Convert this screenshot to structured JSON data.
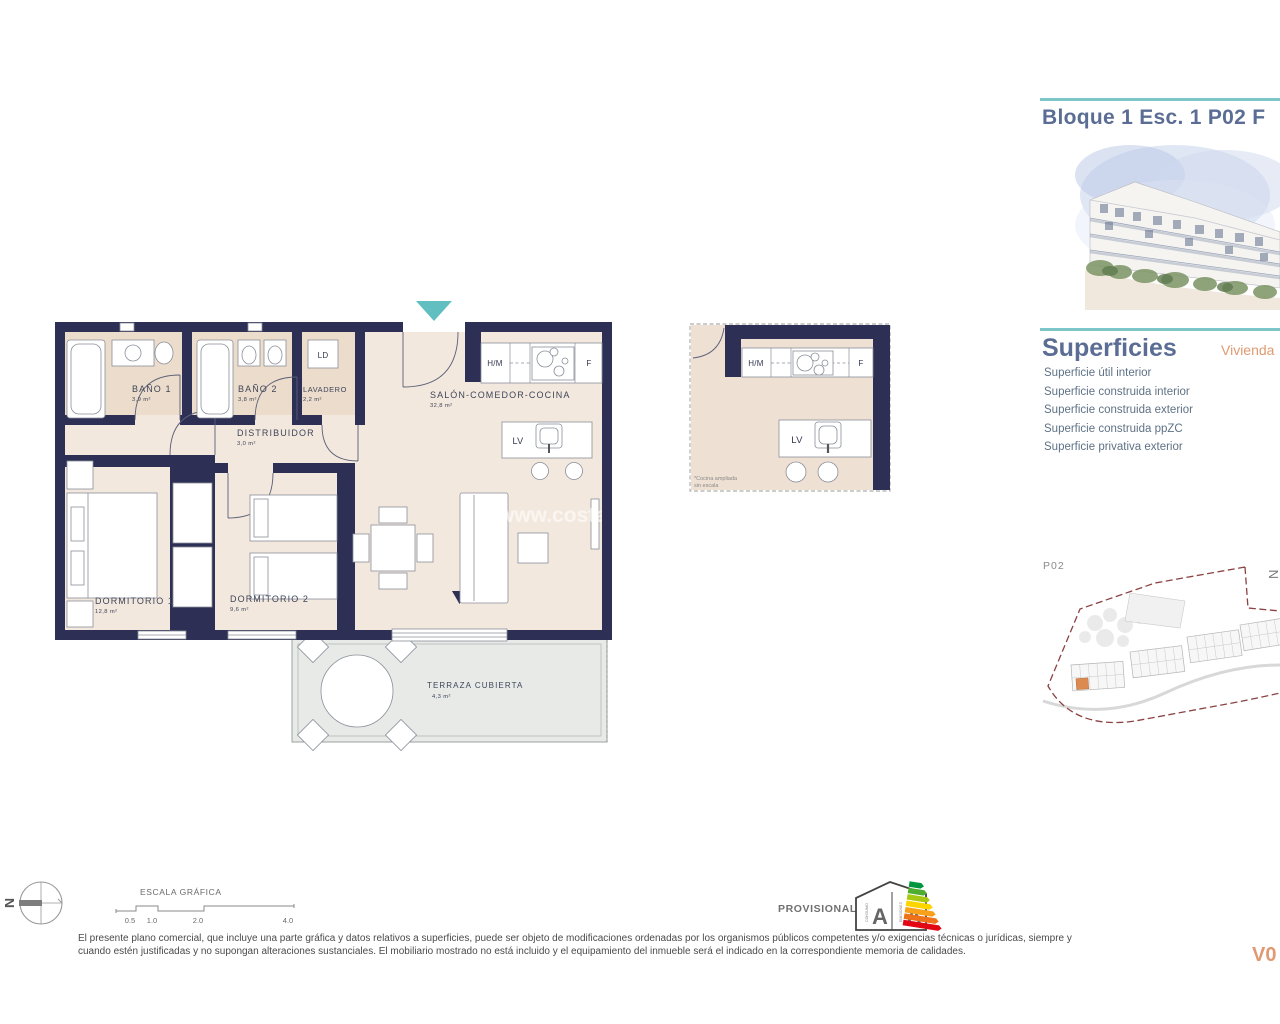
{
  "page": {
    "title": "Bloque 1 Esc. 1 P02 F",
    "version": "V0"
  },
  "superficies": {
    "heading": "Superficies",
    "column_label": "Vivienda",
    "items": [
      "Superficie útil interior",
      "Superficie construida interior",
      "Superficie construida exterior",
      "Superficie construida ppZC",
      "Superficie privativa exterior"
    ]
  },
  "plan": {
    "rooms": [
      {
        "name": "BAÑO 1",
        "area": "3,9 m²"
      },
      {
        "name": "BAÑO 2",
        "area": "3,8 m²"
      },
      {
        "name": "LAVADERO",
        "area": "2,2 m²"
      },
      {
        "name": "DISTRIBUIDOR",
        "area": "3,0 m²"
      },
      {
        "name": "SALÓN-COMEDOR-COCINA",
        "area": "32,8 m²"
      },
      {
        "name": "DORMITORIO 1",
        "area": "12,8 m²"
      },
      {
        "name": "DORMITORIO 2",
        "area": "9,6 m²"
      },
      {
        "name": "TERRAZA CUBIERTA",
        "area": "4,3 m²"
      }
    ],
    "fixtures": {
      "ld": "LD",
      "hm": "H/M",
      "f": "F",
      "lv": "LV"
    },
    "watermark": "www.costablan"
  },
  "detail": {
    "fixtures": {
      "hm": "H/M",
      "f": "F",
      "lv": "LV"
    },
    "note_line1": "*Cocina ampliada",
    "note_line2": "sin escala"
  },
  "siteplan": {
    "label": "P02",
    "north": "N"
  },
  "scalebar": {
    "title": "ESCALA GRÁFICA",
    "ticks": [
      "0.5",
      "1.0",
      "2.0",
      "4.0"
    ]
  },
  "compass": {
    "north": "N"
  },
  "energy": {
    "status": "PROVISIONAL",
    "letter_left": "A",
    "letter_right": "A",
    "consumo": "CONSUMO",
    "emisiones": "EMISIONES"
  },
  "disclaimer": {
    "line1": "El presente plano comercial, que incluye una parte gráfica y datos relativos a superficies, puede ser objeto de modificaciones ordenadas por los organismos públicos competentes y/o exigencias técnicas o jurídicas, siempre y",
    "line2": "cuando estén justificadas y no supongan alteraciones sustanciales. El mobiliario mostrado no está incluido y el equipamiento del inmueble será el indicado en la correspondiente memoria de calidades."
  },
  "colors": {
    "accent_teal": "#7cc5c8",
    "heading_blue": "#5b6d94",
    "accent_orange": "#df9a70",
    "wall_navy": "#2d2f55"
  }
}
